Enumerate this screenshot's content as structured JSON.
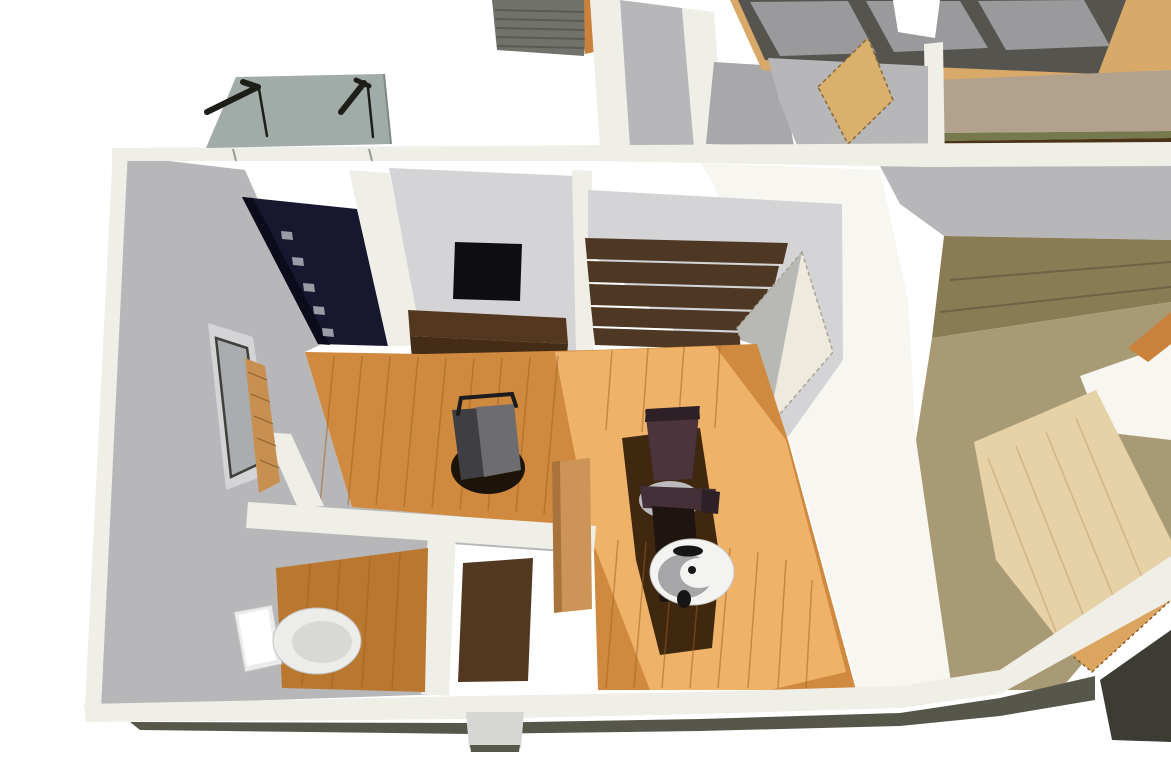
{
  "scene": {
    "kind": "3d-architectural-cutaway-render",
    "view": "top-down oblique dollhouse view of single-story interior",
    "rooms": [
      "entry-treatment-room",
      "toilet-room",
      "entry-closet",
      "stair-hall",
      "wood-clad-hallway",
      "upper-room-with-windows"
    ],
    "objects": [
      "glass-entrance-canopy",
      "canopy-support-brackets",
      "entry-ceiling-panel",
      "recessed-downlights",
      "wall-mounted-tv",
      "media-counter",
      "staircase-treads",
      "open-door-panel",
      "treatment-chair",
      "spittoon-basin",
      "operator-stool",
      "side-window-with-blind",
      "toilet",
      "entry-mat",
      "shoe-cabinet",
      "skylight-window-row",
      "tatami-edge-strip",
      "pale-wood-floor",
      "foundation-base",
      "entrance-step"
    ]
  },
  "palette": {
    "white": "#ffffff",
    "wall_cut": "#efeee7",
    "wall_bright": "#f7f6f1",
    "wall_gray": "#b7b7b9",
    "wall_gray_dark": "#a8a8aa",
    "wall_gray_light": "#d4d4d6",
    "glass_canopy": "#9aa5a1",
    "glass_canopy_edge": "#7e8a86",
    "rod_dark": "#1e1e18",
    "roof_gray": "#72726c",
    "roof_line": "#5a5a55",
    "ceiling_navy": "#171730",
    "ceiling_navy_edge": "#0b0b1a",
    "light_square": "#9b9ba6",
    "floor_wood": "#cf8a40",
    "floor_wood_lit": "#eeb269",
    "floor_wood_dim": "#b9772f",
    "floor_plank_line": "#9c6120",
    "shadow_dark": "#40270f",
    "tv_black": "#0e0e10",
    "counter_brown": "#54371f",
    "counter_brown_dark": "#452c17",
    "stair_brown": "#4e3823",
    "door_cream": "#eeeadd",
    "door_cream_shade": "#b8b8b4",
    "door_dash": "#a9a396",
    "chair_maroon": "#4b343c",
    "chair_maroon_dark": "#2d2026",
    "chair_seat": "#433039",
    "chair_base_gray": "#bcbcbe",
    "chair_column": "#1e1410",
    "basin_white": "#f3f3f1",
    "basin_rim": "#c9c9c7",
    "basin_gray": "#a6a6a8",
    "basin_dark": "#161616",
    "stool_gray": "#6c6c71",
    "stool_gray_dark": "#3e3e43",
    "stool_shadow": "#1c1309",
    "stool_arm": "#1c1c1c",
    "toilet_white": "#ececea",
    "toilet_edge": "#c2c2c0",
    "toilet_shade": "#d8d8d6",
    "window_glass": "#a9adaf",
    "window_frame": "#3f3f3b",
    "slat_wood": "#c89050",
    "slat_line": "#8a5f2e",
    "pane_gray": "#9a9a9c",
    "frame_dark": "#55544e",
    "sill_tan": "#d9a96a",
    "taupe_wall": "#b2a18d",
    "tatami_green": "#75794d",
    "floor_dark_brown": "#4a3418",
    "olive_wood": "#a89a74",
    "olive_wood_dark": "#897b54",
    "olive_line": "#6e6244",
    "pale_wood": "#e7d1a7",
    "pale_wood_line": "#d2b586",
    "orange_wood": "#c9813b",
    "orange_wood_light": "#dba55f",
    "orange_dash": "#8a5a28",
    "mat_brown": "#523721",
    "cabinet_tan": "#cd9457",
    "cabinet_tan_dark": "#a9743c",
    "door_tan": "#d9b06c",
    "door_tan_dash": "#8a6a3a",
    "foundation": "#56564b",
    "foundation_dark": "#3c3c34",
    "step_gray": "#d6d6d4",
    "nick_gray": "#9a9a98"
  }
}
